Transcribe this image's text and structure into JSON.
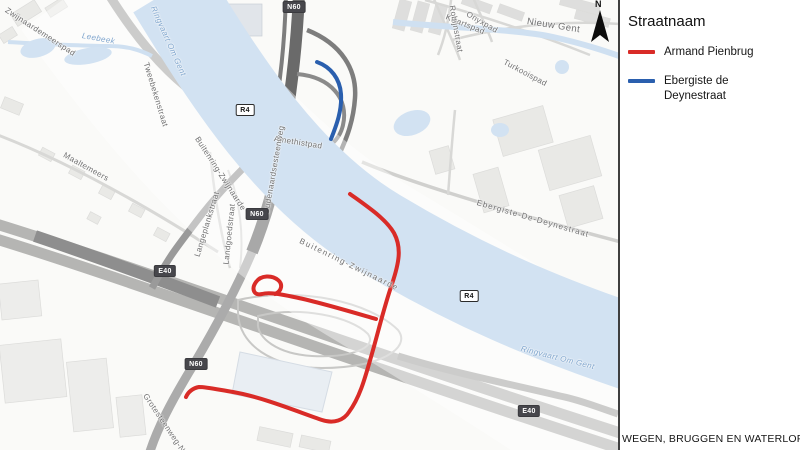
{
  "legend": {
    "title": "Straatnaam",
    "items": [
      {
        "id": "armand-pienbrug",
        "label": "Armand Pienbrug",
        "color": "#d92b27"
      },
      {
        "id": "ebergiste-de-deynestraat",
        "label": "Ebergiste de Deynestraat",
        "color": "#2a5fae"
      }
    ]
  },
  "caption": "WEGEN, BRUGGEN EN WATERLOPEN",
  "north_label": "N",
  "map": {
    "water_color": "#d2e2f2",
    "water_name": "Ringvaart Om Gent",
    "road_badges": [
      {
        "label": "N60",
        "style": "dark",
        "x": 294,
        "y": 7
      },
      {
        "label": "R4",
        "style": "light",
        "x": 245,
        "y": 110
      },
      {
        "label": "N60",
        "style": "dark",
        "x": 257,
        "y": 214
      },
      {
        "label": "R4",
        "style": "light",
        "x": 469,
        "y": 296
      },
      {
        "label": "E40",
        "style": "dark",
        "x": 165,
        "y": 271
      },
      {
        "label": "N60",
        "style": "dark",
        "x": 196,
        "y": 364
      },
      {
        "label": "E40",
        "style": "dark",
        "x": 529,
        "y": 411
      }
    ],
    "street_labels": [
      {
        "text": "Zwijnaardemeerspad",
        "x": 6,
        "y": 5,
        "rot": 33
      },
      {
        "text": "Leebeek",
        "x": 82,
        "y": 31,
        "rot": 10,
        "water": true
      },
      {
        "text": "Ringvaart Om Gent",
        "x": 153,
        "y": 2,
        "rot": 66,
        "water": true
      },
      {
        "text": "Tweebekenstraat",
        "x": 146,
        "y": 58,
        "rot": 73
      },
      {
        "text": "Kwartspad",
        "x": 446,
        "y": 12,
        "rot": 22
      },
      {
        "text": "Onyxpad",
        "x": 467,
        "y": 9,
        "rot": 30
      },
      {
        "text": "Robijnstraat",
        "x": 452,
        "y": 1,
        "rot": 80
      },
      {
        "text": "Nieuw Gent",
        "x": 527,
        "y": 16,
        "rot": 9,
        "size": 9.5
      },
      {
        "text": "Turkooispad",
        "x": 504,
        "y": 57,
        "rot": 28
      },
      {
        "text": "Amethistpad",
        "x": 274,
        "y": 134,
        "rot": 9
      },
      {
        "text": "Maaltemeers",
        "x": 64,
        "y": 150,
        "rot": 29
      },
      {
        "text": "Langeplankstraat",
        "x": 197,
        "y": 252,
        "rot": -73
      },
      {
        "text": "Landgoedstraat",
        "x": 226,
        "y": 260,
        "rot": -84
      },
      {
        "text": "Oudenaardsesteenweg",
        "x": 266,
        "y": 210,
        "rot": -80
      },
      {
        "text": "Buitenring-Zwijnaarde",
        "x": 197,
        "y": 133,
        "rot": 57
      },
      {
        "text": "Buitenring-Zwijnaarde",
        "x": 300,
        "y": 236,
        "rot": 26,
        "spacing": 1.5
      },
      {
        "text": "Ebergiste-De-Deynestraat",
        "x": 477,
        "y": 198,
        "rot": 16,
        "spacing": 1
      },
      {
        "text": "Grotesteenweg-Noord",
        "x": 145,
        "y": 390,
        "rot": 56
      },
      {
        "text": "Ringvaart Om Gent",
        "x": 521,
        "y": 344,
        "rot": 14,
        "water": true
      }
    ]
  }
}
